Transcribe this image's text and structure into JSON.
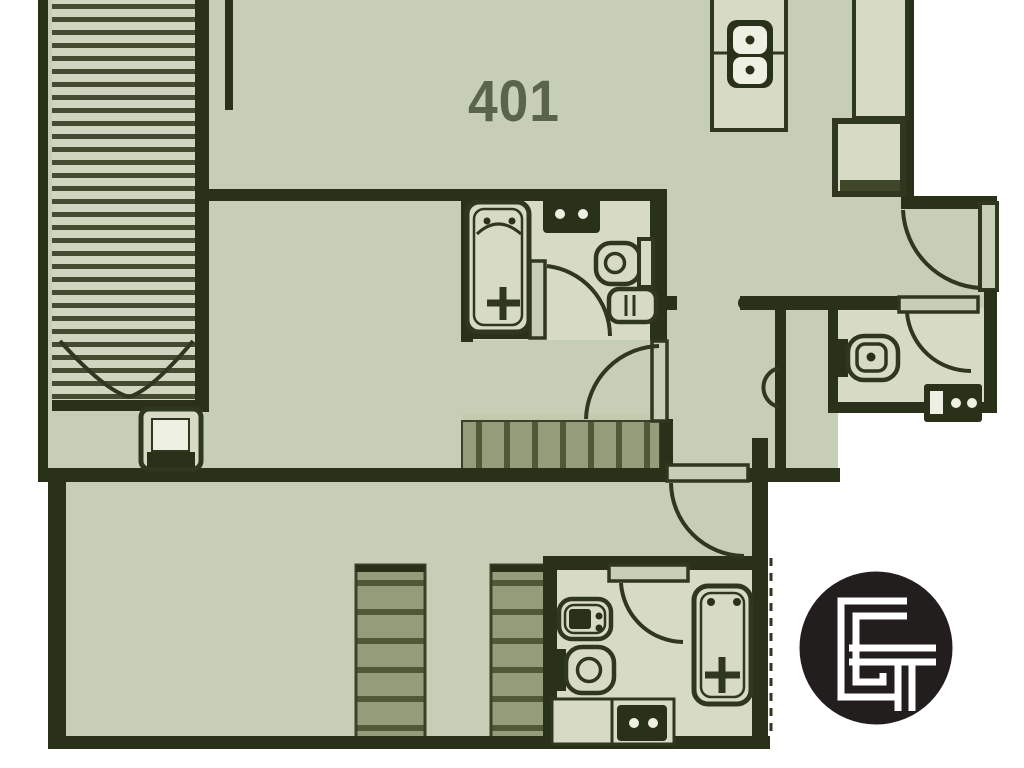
{
  "unit_number": "401",
  "logo": {
    "monogram": "GT",
    "style": "black-circle-white-interlocked-monogram"
  },
  "palette": {
    "paper": "#ffffff",
    "floor": "#c7ceb6",
    "floor_light": "#d7dbc5",
    "wall": "#2a3119",
    "line": "#2f3720",
    "stair_fill": "#949d7a",
    "stair_tread": "#4f5937",
    "stripe_bar": "#434c31",
    "stripe_bg": "#cfd5bf",
    "stair_edge": "#39412a",
    "cap_light": "#c3caae",
    "shadow": "#3f4729",
    "unit_text": "#5a644b",
    "logo_black": "#211e1d",
    "inner_white": "#eef0e4"
  },
  "rooms": {
    "kitchen_hall": {
      "fixtures": [
        "kitchen-island",
        "cooktop-2-burner",
        "counter",
        "refrigerator"
      ]
    },
    "main_bathroom": {
      "fixtures": [
        "bathtub",
        "vanity-sink",
        "toilet",
        "bidet"
      ]
    },
    "powder_room": {
      "fixtures": [
        "toilet",
        "vanity-sink"
      ]
    },
    "lower_bathroom": {
      "fixtures": [
        "bidet",
        "toilet",
        "bathtub",
        "vanity-sink"
      ]
    },
    "bedroom": {
      "fixtures": [
        "tv-unit"
      ]
    }
  },
  "stairs": [
    "exterior-side-stairs",
    "mid-level-stairs",
    "lower-stairs-run-1",
    "lower-stairs-run-2"
  ],
  "doors": [
    "entry-door",
    "powder-room-door",
    "main-bathroom-door",
    "hall-door",
    "lower-level-door",
    "lower-bathroom-door"
  ]
}
